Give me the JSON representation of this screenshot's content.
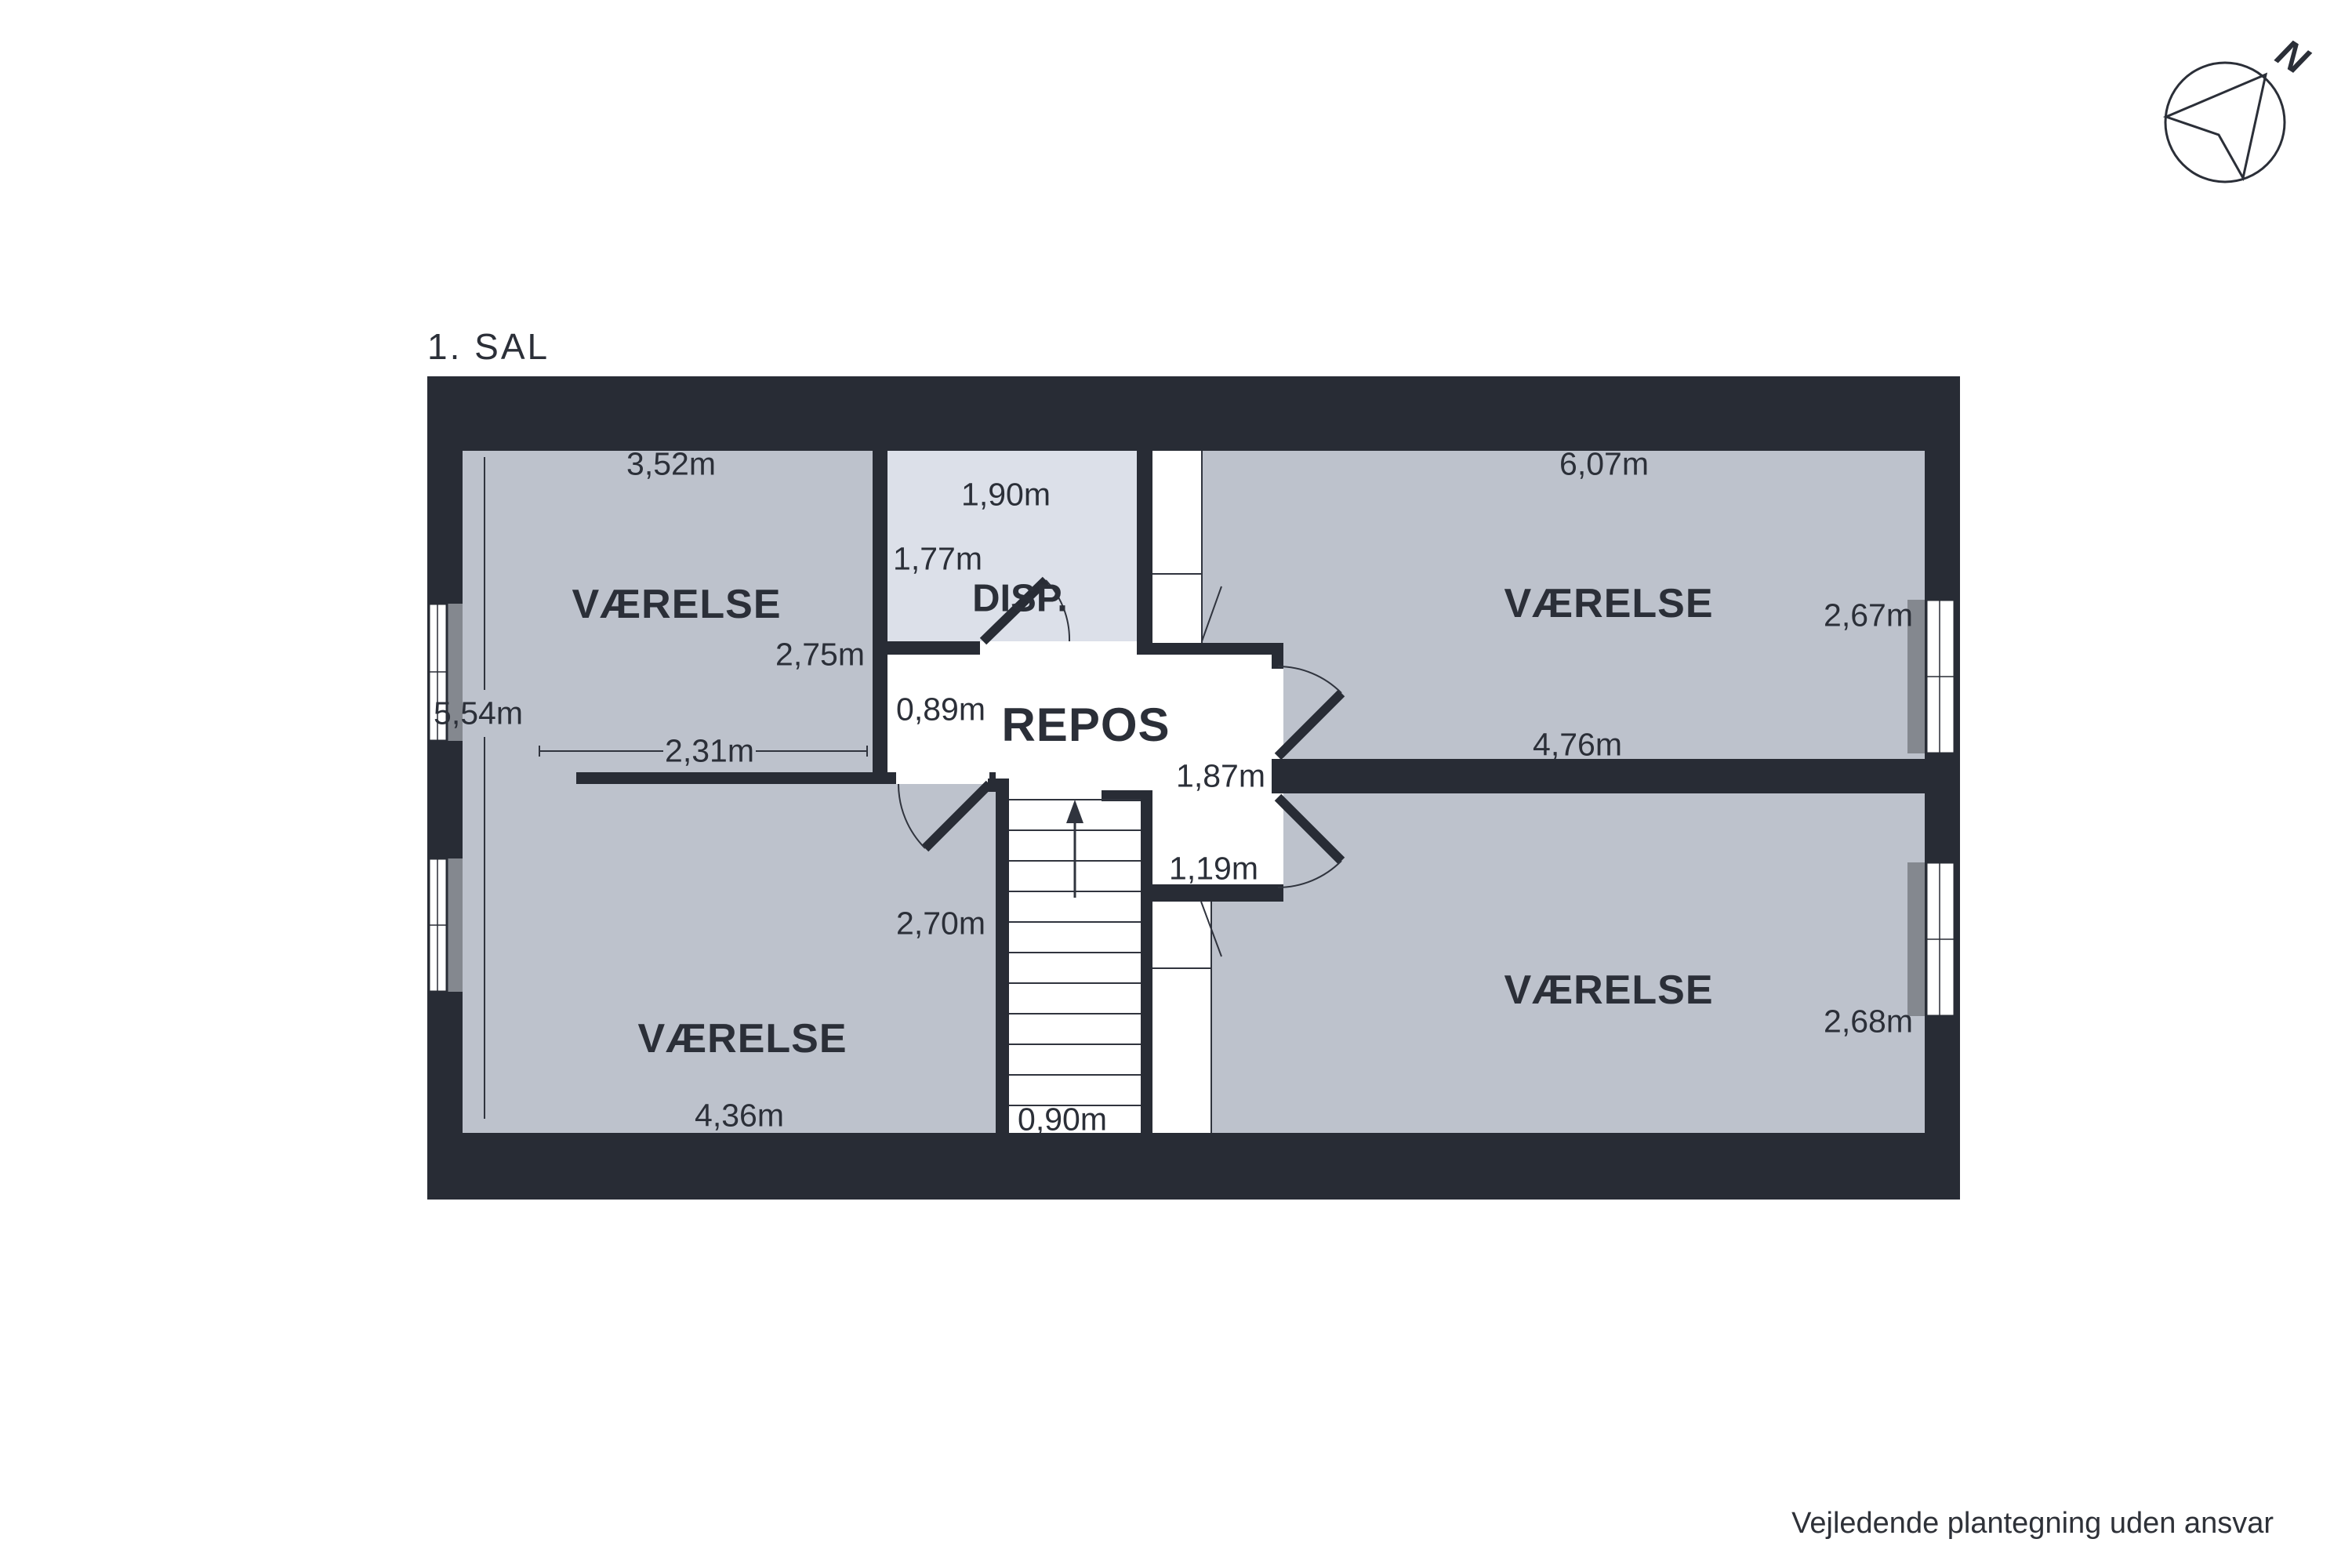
{
  "title": "1. SAL",
  "disclaimer": "Vejledende plantegning uden ansvar",
  "compass": {
    "north_label": "N"
  },
  "colors": {
    "wall": "#282c35",
    "room_fill": "#bdc2cc",
    "disp_fill": "#dce0e9",
    "floor_white": "#ffffff",
    "window_sill": "#84888f",
    "text": "#2b2f38"
  },
  "rooms": {
    "top_left": {
      "name": "VÆRELSE",
      "width": "3,52m",
      "height": "2,75m",
      "wall_segment": "2,31m"
    },
    "bottom_left": {
      "name": "VÆRELSE",
      "width": "4,36m",
      "height": "2,70m"
    },
    "left_total_height": "5,54m",
    "disp": {
      "name": "DISP.",
      "width": "1,90m",
      "height": "1,77m"
    },
    "repos": {
      "name": "REPOS",
      "left_width": "0,89m",
      "right_width": "1,87m",
      "nook_width": "1,19m"
    },
    "stairs": {
      "width": "0,90m"
    },
    "top_right": {
      "name": "VÆRELSE",
      "width": "6,07m",
      "height": "2,67m",
      "lower_width": "4,76m"
    },
    "bottom_right": {
      "name": "VÆRELSE",
      "height": "2,68m"
    }
  }
}
